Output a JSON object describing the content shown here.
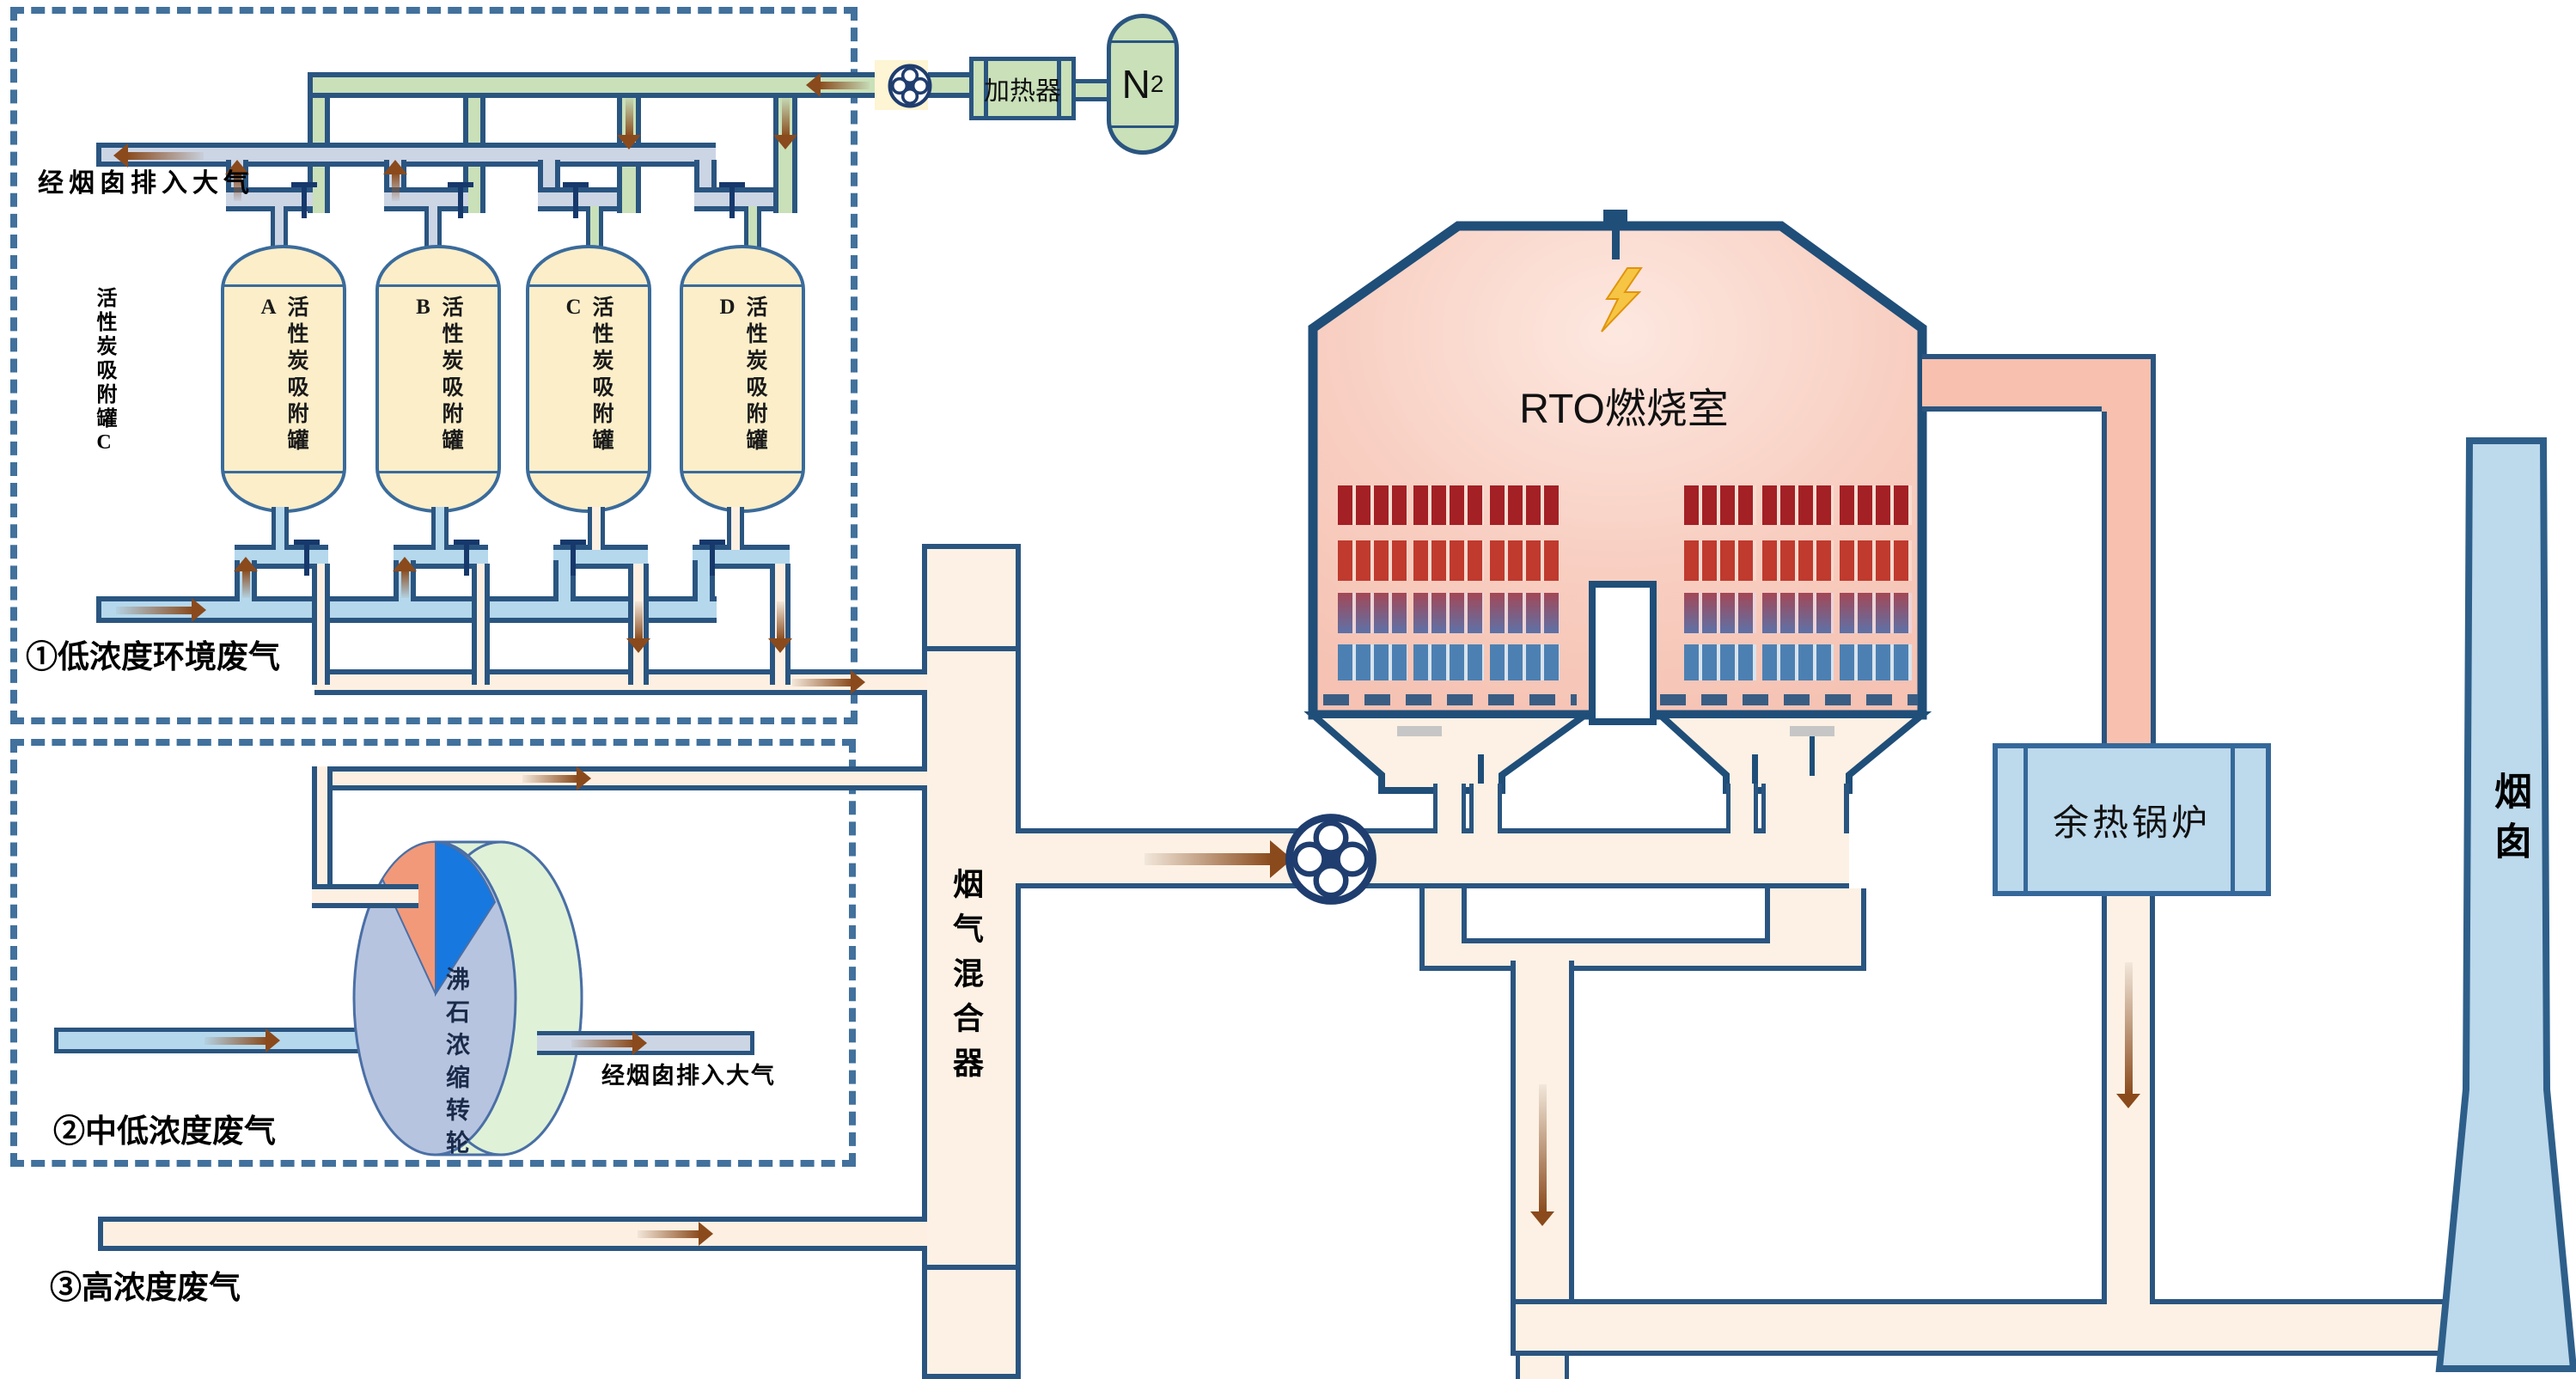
{
  "streams": {
    "s1": "①低浓度环境废气",
    "s2": "②中低浓度废气",
    "s3": "③高浓度废气"
  },
  "labels": {
    "to_atmosphere_top": "经烟囱排入大气",
    "to_atmosphere_rotor": "经烟囱排入大气",
    "carbon_bank_side": "活性炭吸附罐C"
  },
  "tanks": [
    {
      "label": "活性炭吸附罐A"
    },
    {
      "label": "活性炭吸附罐B"
    },
    {
      "label": "活性炭吸附罐C"
    },
    {
      "label": "活性炭吸附罐D"
    }
  ],
  "equipment": {
    "heater": "加热器",
    "n2_main": "N",
    "n2_sub": "2",
    "rto": "RTO燃烧室",
    "rotor": "沸石浓缩转轮",
    "mixer": "烟气混合器",
    "boiler": "余热锅炉",
    "chimney": "烟囱"
  },
  "colors": {
    "pipe_border": "#2a5580",
    "green_pipe": "#c9e0b8",
    "gray_pipe": "#ccd5e4",
    "blue_pipe": "#b5d8ec",
    "cream_pipe": "#fdf0e2",
    "pink_pipe": "#f8c0ae",
    "tank_fill": "#fbeec9",
    "boiler_fill": "#bdd9ec",
    "arrow_brown": "#8a4a1c",
    "dashed_box": "#41719c"
  }
}
